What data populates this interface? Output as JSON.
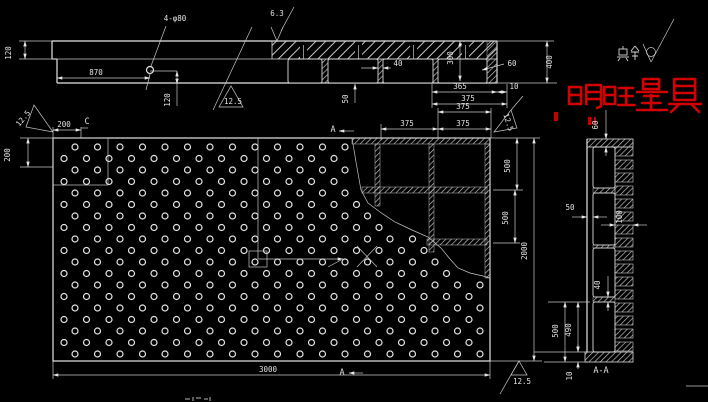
{
  "watermark": {
    "text": "明旺量具",
    "color": "#d40000"
  },
  "finish_note": {
    "prefix": "其余"
  },
  "labels": {
    "d120_top_left": "120",
    "d870": "870",
    "hole_callout": "4-φ80",
    "rough_63": "6.3",
    "d120_hole": "120",
    "rough_125_front": "12.5",
    "d40_rib": "40",
    "d300": "300",
    "d60_rib": "60",
    "d400": "400",
    "d365": "365",
    "d10_top": "10",
    "d375_top": "375",
    "d50_top": "50",
    "d200_h": "200",
    "d200_v": "200",
    "detail_c": "C",
    "rough_125_main": "12.5",
    "sec_a_top": "A",
    "d375_a": "375",
    "d375_b": "375",
    "d375_c": "375",
    "rough_125_tr": "12.5",
    "d500_a": "500",
    "d500_b": "500",
    "d2000": "2000",
    "d3000": "3000",
    "sec_a_bottom": "A",
    "rough_125_br": "12.5",
    "d60_side": "60",
    "d50_side": "50",
    "d100_side": "100",
    "d40_side": "40",
    "d500_side": "500",
    "d490_side": "490",
    "d10_side": "10",
    "sec_label": "A-A"
  },
  "hole_pattern": {
    "rows": 19,
    "row0_y": 147,
    "row_pitch": 11.5,
    "col_pitch": 22.5,
    "x_start_even": 75,
    "x_start_odd": 64,
    "x_max": 482,
    "radius": 3
  }
}
